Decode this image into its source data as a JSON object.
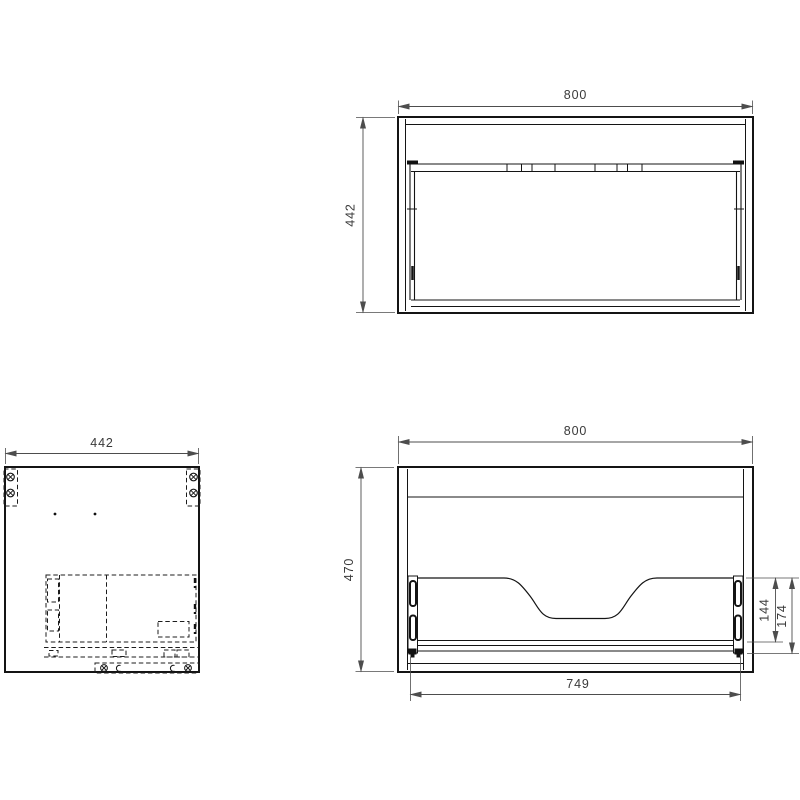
{
  "drawing": {
    "type": "technical-orthographic-drawing",
    "subject": "wall-hung vanity cabinet with drawer",
    "colors": {
      "background": "#ffffff",
      "geometry_line": "#141414",
      "dimension_line": "#4d4d4d",
      "dimension_text": "#3a3a3a"
    },
    "views": {
      "top": {
        "label": "top view",
        "dims": {
          "width": "800",
          "depth": "442"
        }
      },
      "side": {
        "label": "side view",
        "dims": {
          "depth": "442"
        },
        "symbols": [
          "fixing-screw-icon",
          "fixing-screw-icon",
          "fixing-screw-icon",
          "fixing-screw-icon",
          "clip-icon",
          "clip-icon"
        ]
      },
      "front": {
        "label": "front view (open, drawer without front panel)",
        "dims": {
          "width": "800",
          "height": "470",
          "drawer_opening_width": "749",
          "drawer_back_height": "144",
          "drawer_zone_height": "174"
        }
      }
    }
  }
}
